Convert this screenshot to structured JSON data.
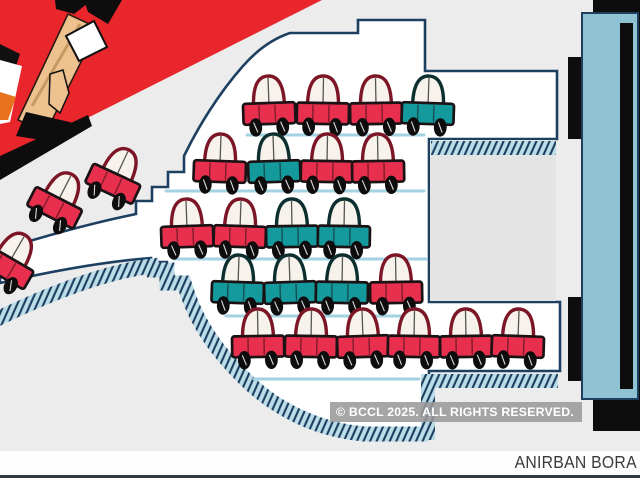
{
  "meta": {
    "title": "Editorial cartoon: queues of cars forming an electric plug entering a socket"
  },
  "watermark": {
    "text": "© BCCL 2025. ALL RIGHTS RESERVED."
  },
  "credit": {
    "text": "ANIRBAN BORA"
  },
  "scene": {
    "colors": {
      "background": "#ececec",
      "banner_red": "#e8262b",
      "outline_navy": "#1d3f60",
      "hatch_blue": "#bcdce8",
      "lane_blue": "#a5d2e0",
      "car_red": "#e8304e",
      "car_red_arch": "#7c1626",
      "car_teal": "#149a9c",
      "car_teal_arch": "#0e2f2f",
      "socket_black": "#0d0d0d",
      "socket_panel_blue": "#8fc3d3",
      "recess_gray": "#e4e4e4",
      "watermark_text": "#ffffff",
      "credit_text": "#3a3a3a"
    }
  },
  "traffic": {
    "lane_lines": [
      {
        "x1": 247,
        "x2": 424,
        "y": 135
      },
      {
        "x1": 166,
        "x2": 424,
        "y": 191
      },
      {
        "x1": 174,
        "x2": 426,
        "y": 259
      },
      {
        "x1": 226,
        "x2": 426,
        "y": 316
      },
      {
        "x1": 254,
        "x2": 419,
        "y": 379
      }
    ],
    "rows": [
      {
        "y": 73,
        "cars": [
          {
            "x": 245,
            "color": "red",
            "r": -2
          },
          {
            "x": 299,
            "color": "red",
            "r": 1
          },
          {
            "x": 352,
            "color": "red",
            "r": -1
          },
          {
            "x": 404,
            "color": "teal",
            "r": 2
          }
        ]
      },
      {
        "y": 131,
        "cars": [
          {
            "x": 196,
            "color": "red",
            "r": 2
          },
          {
            "x": 250,
            "color": "teal",
            "r": -2
          },
          {
            "x": 303,
            "color": "red",
            "r": 1
          },
          {
            "x": 354,
            "color": "red",
            "r": -1
          }
        ]
      },
      {
        "y": 196,
        "cars": [
          {
            "x": 163,
            "color": "red",
            "r": -2
          },
          {
            "x": 216,
            "color": "red",
            "r": 2
          },
          {
            "x": 268,
            "color": "teal",
            "r": -1
          },
          {
            "x": 320,
            "color": "teal",
            "r": 1
          }
        ]
      },
      {
        "y": 252,
        "cars": [
          {
            "x": 214,
            "color": "teal",
            "r": 2
          },
          {
            "x": 266,
            "color": "teal",
            "r": -2
          },
          {
            "x": 318,
            "color": "teal",
            "r": 1
          },
          {
            "x": 372,
            "color": "red",
            "r": -1
          }
        ]
      },
      {
        "y": 306,
        "cars": [
          {
            "x": 234,
            "color": "red",
            "r": -1
          },
          {
            "x": 287,
            "color": "red",
            "r": 1
          },
          {
            "x": 339,
            "color": "red",
            "r": -2
          },
          {
            "x": 390,
            "color": "red",
            "r": 1
          },
          {
            "x": 442,
            "color": "red",
            "r": -1
          },
          {
            "x": 494,
            "color": "red",
            "r": 2
          }
        ]
      }
    ],
    "queue": [
      {
        "x": -14,
        "y": 228,
        "rot": 30,
        "color": "red"
      },
      {
        "x": 34,
        "y": 168,
        "rot": 27,
        "color": "red"
      },
      {
        "x": 92,
        "y": 144,
        "rot": 25,
        "color": "red"
      }
    ]
  }
}
